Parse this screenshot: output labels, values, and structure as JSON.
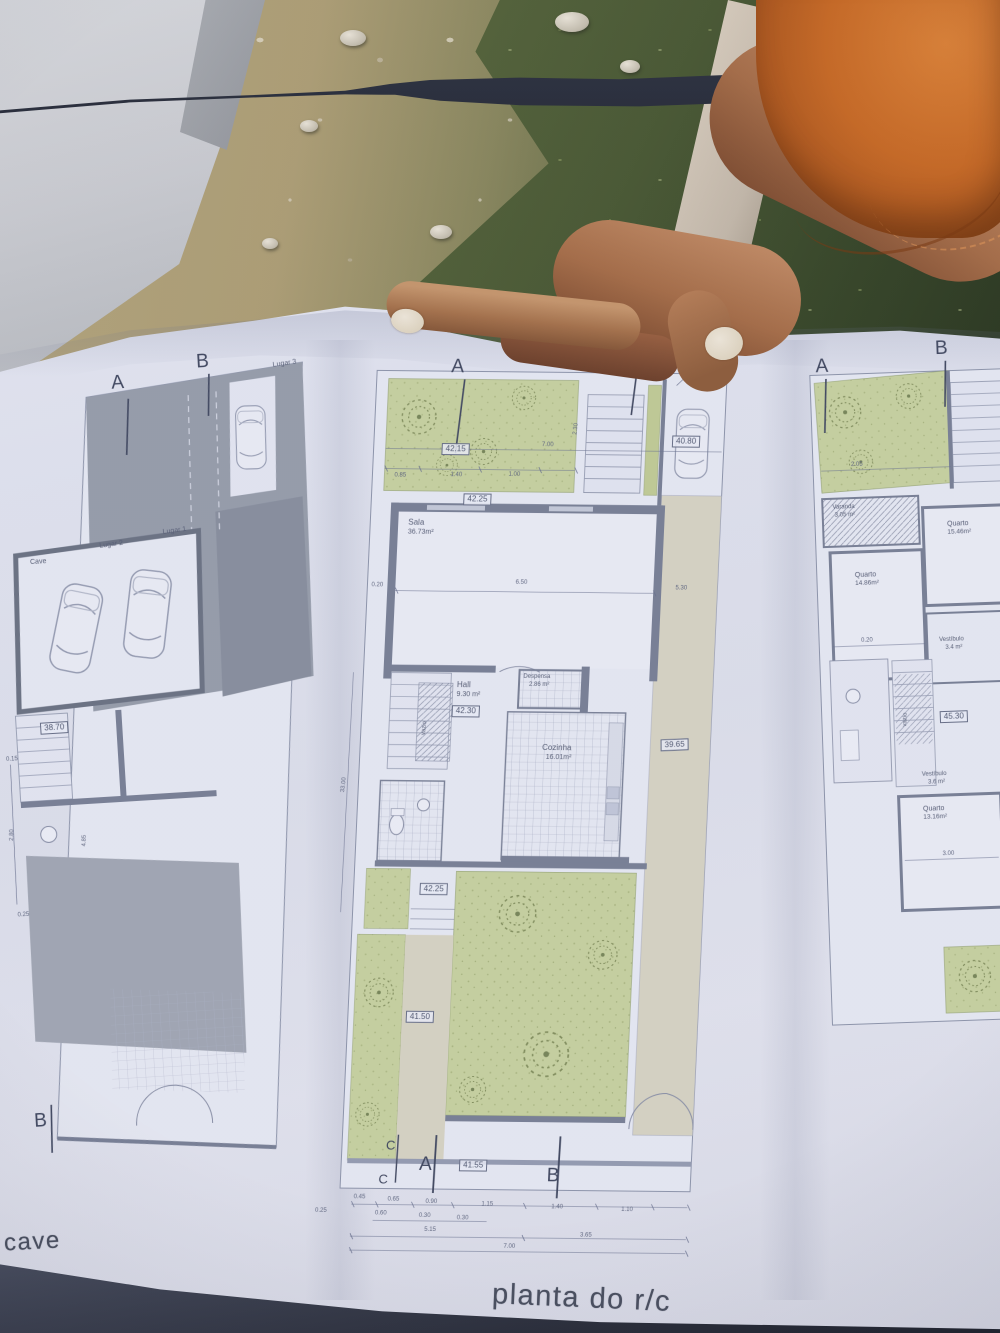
{
  "palette": {
    "sleeve_orange": "#c4682a",
    "plan_green": "#ccd6a2",
    "paper_blue_white": "#e8eaf3",
    "grass_green": "#4e5c38",
    "gravel_tan": "#b3a478",
    "plan_wall_gray": "#7d8498"
  },
  "captions": {
    "cave": "cave",
    "rc": "planta do r/c"
  },
  "cave_plan": {
    "marker_a": "A",
    "marker_b_top": "B",
    "marker_b_bottom": "B",
    "lugar_3": "Lugar 3",
    "lugar_2": "Lugar 2",
    "lugar_1": "Lugar 1",
    "room_label": "Cave",
    "elevation": "38.70",
    "dims": [
      "0.15",
      "2.80",
      "0.25",
      "4.85"
    ]
  },
  "rc_plan": {
    "marker_a_top": "A",
    "marker_b_top": "B",
    "marker_c_top": "C",
    "marker_c_bottom": "C",
    "marker_a_bottom": "A",
    "marker_b_bottom": "B",
    "parking_note": "lugar de estac.",
    "elevations": {
      "garden_top": "42.15",
      "driveway": "40.80",
      "yard_upper": "42.25",
      "hall": "42.30",
      "side_corridor": "39.65",
      "yard_mid": "42.25",
      "garden_low": "41.50",
      "entry": "41.55"
    },
    "rooms": {
      "sala": "Sala",
      "sala_area": "36.73m²",
      "hall": "Hall",
      "hall_area": "9.30 m²",
      "cozinha": "Cozinha",
      "cozinha_area": "16.01m²",
      "despensa": "Despensa",
      "despensa_area": "2.86 m²",
      "vazio": "vazio"
    },
    "dims_garden": [
      "0.85",
      "1.40",
      "1.00",
      "7.00",
      "2.30"
    ],
    "dims_sala": [
      "0.20",
      "6.50",
      "5.30"
    ],
    "dim_left_height": "33.00",
    "dim_left_offset": "0.25",
    "dims_row1": [
      "0.45",
      "0.65",
      "0.90",
      "1.15",
      "1.40",
      "1.10"
    ],
    "dims_row2": [
      "0.60",
      "0.30",
      "0.30"
    ],
    "dims_row3": [
      "5.15",
      "3.65"
    ],
    "dims_row4": [
      "7.00"
    ]
  },
  "first_plan": {
    "marker_a": "A",
    "marker_b": "B",
    "varanda": "Varanda",
    "varanda_area": "3.05 m²",
    "quarto_tr": "Quarto",
    "quarto_tr_area": "15.46m²",
    "quarto_left": "Quarto",
    "quarto_left_area": "14.86m²",
    "quarto_bottom": "Quarto",
    "quarto_bottom_area": "13.16m²",
    "vestibulo_1": "Vestíbulo",
    "vestibulo_1_area": "3.4 m²",
    "vestibulo_2": "Vestíbulo",
    "vestibulo_2_area": "3.6 m²",
    "vazio": "vazio",
    "elevation": "45.30",
    "dims": [
      "2.05",
      "0.20",
      "3.00"
    ]
  }
}
